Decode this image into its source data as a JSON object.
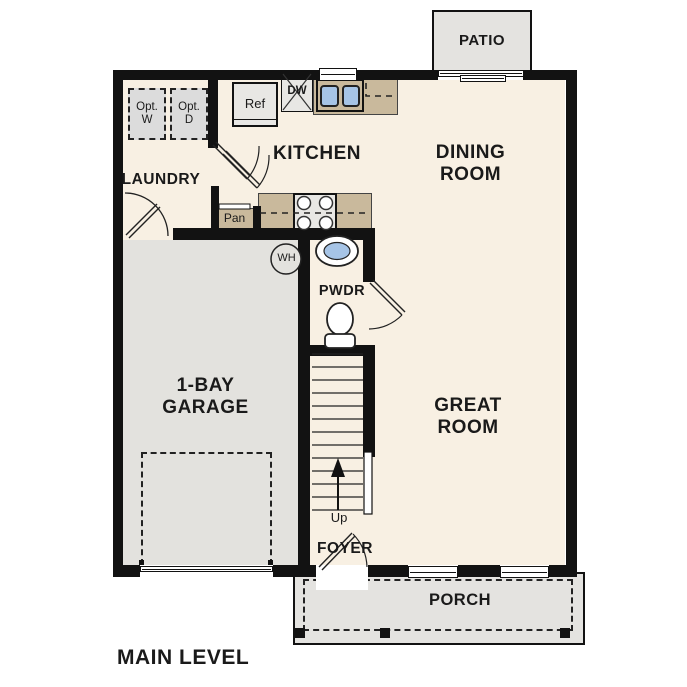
{
  "title": "MAIN LEVEL",
  "colors": {
    "wall": "#121212",
    "floor": "#f8f0e3",
    "garage_floor": "#e3e2de",
    "outdoor": "#e4e3e0",
    "counter": "#c9b99c",
    "sink": "#a6c4e6",
    "appliance": "#e8e7e4",
    "text": "#1a1a1a"
  },
  "rooms": {
    "patio": "PATIO",
    "laundry": "LAUNDRY",
    "kitchen": "KITCHEN",
    "dining": "DINING\nROOM",
    "garage": "1-BAY\nGARAGE",
    "powder": "PWDR",
    "great": "GREAT\nROOM",
    "foyer": "FOYER",
    "porch": "PORCH"
  },
  "labels": {
    "opt_washer": "Opt.\nW",
    "opt_dryer": "Opt.\nD",
    "refrigerator": "Ref",
    "dishwasher": "DW",
    "pantry": "Pan",
    "water_heater": "WH",
    "stairs_up": "Up"
  }
}
